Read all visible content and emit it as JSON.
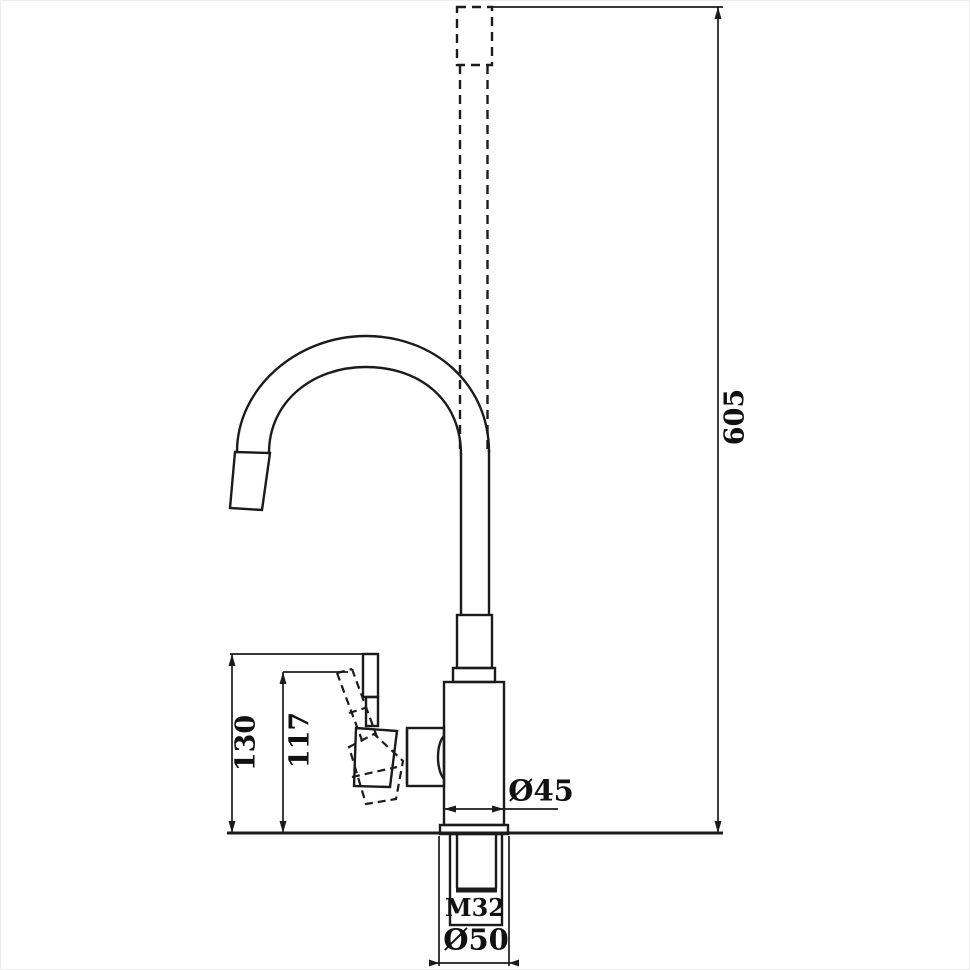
{
  "canvas": {
    "background": "#ffffff",
    "ink": "#1b1b1b"
  },
  "drawing": {
    "kind": "kitchen-faucet-dimension-drawing",
    "labels": {
      "overall_height": "605",
      "base_to_handle_top": "130",
      "base_to_handle_pivot": "117",
      "body_diameter": "Ø45",
      "thread": "M32",
      "base_diameter": "Ø50"
    }
  }
}
